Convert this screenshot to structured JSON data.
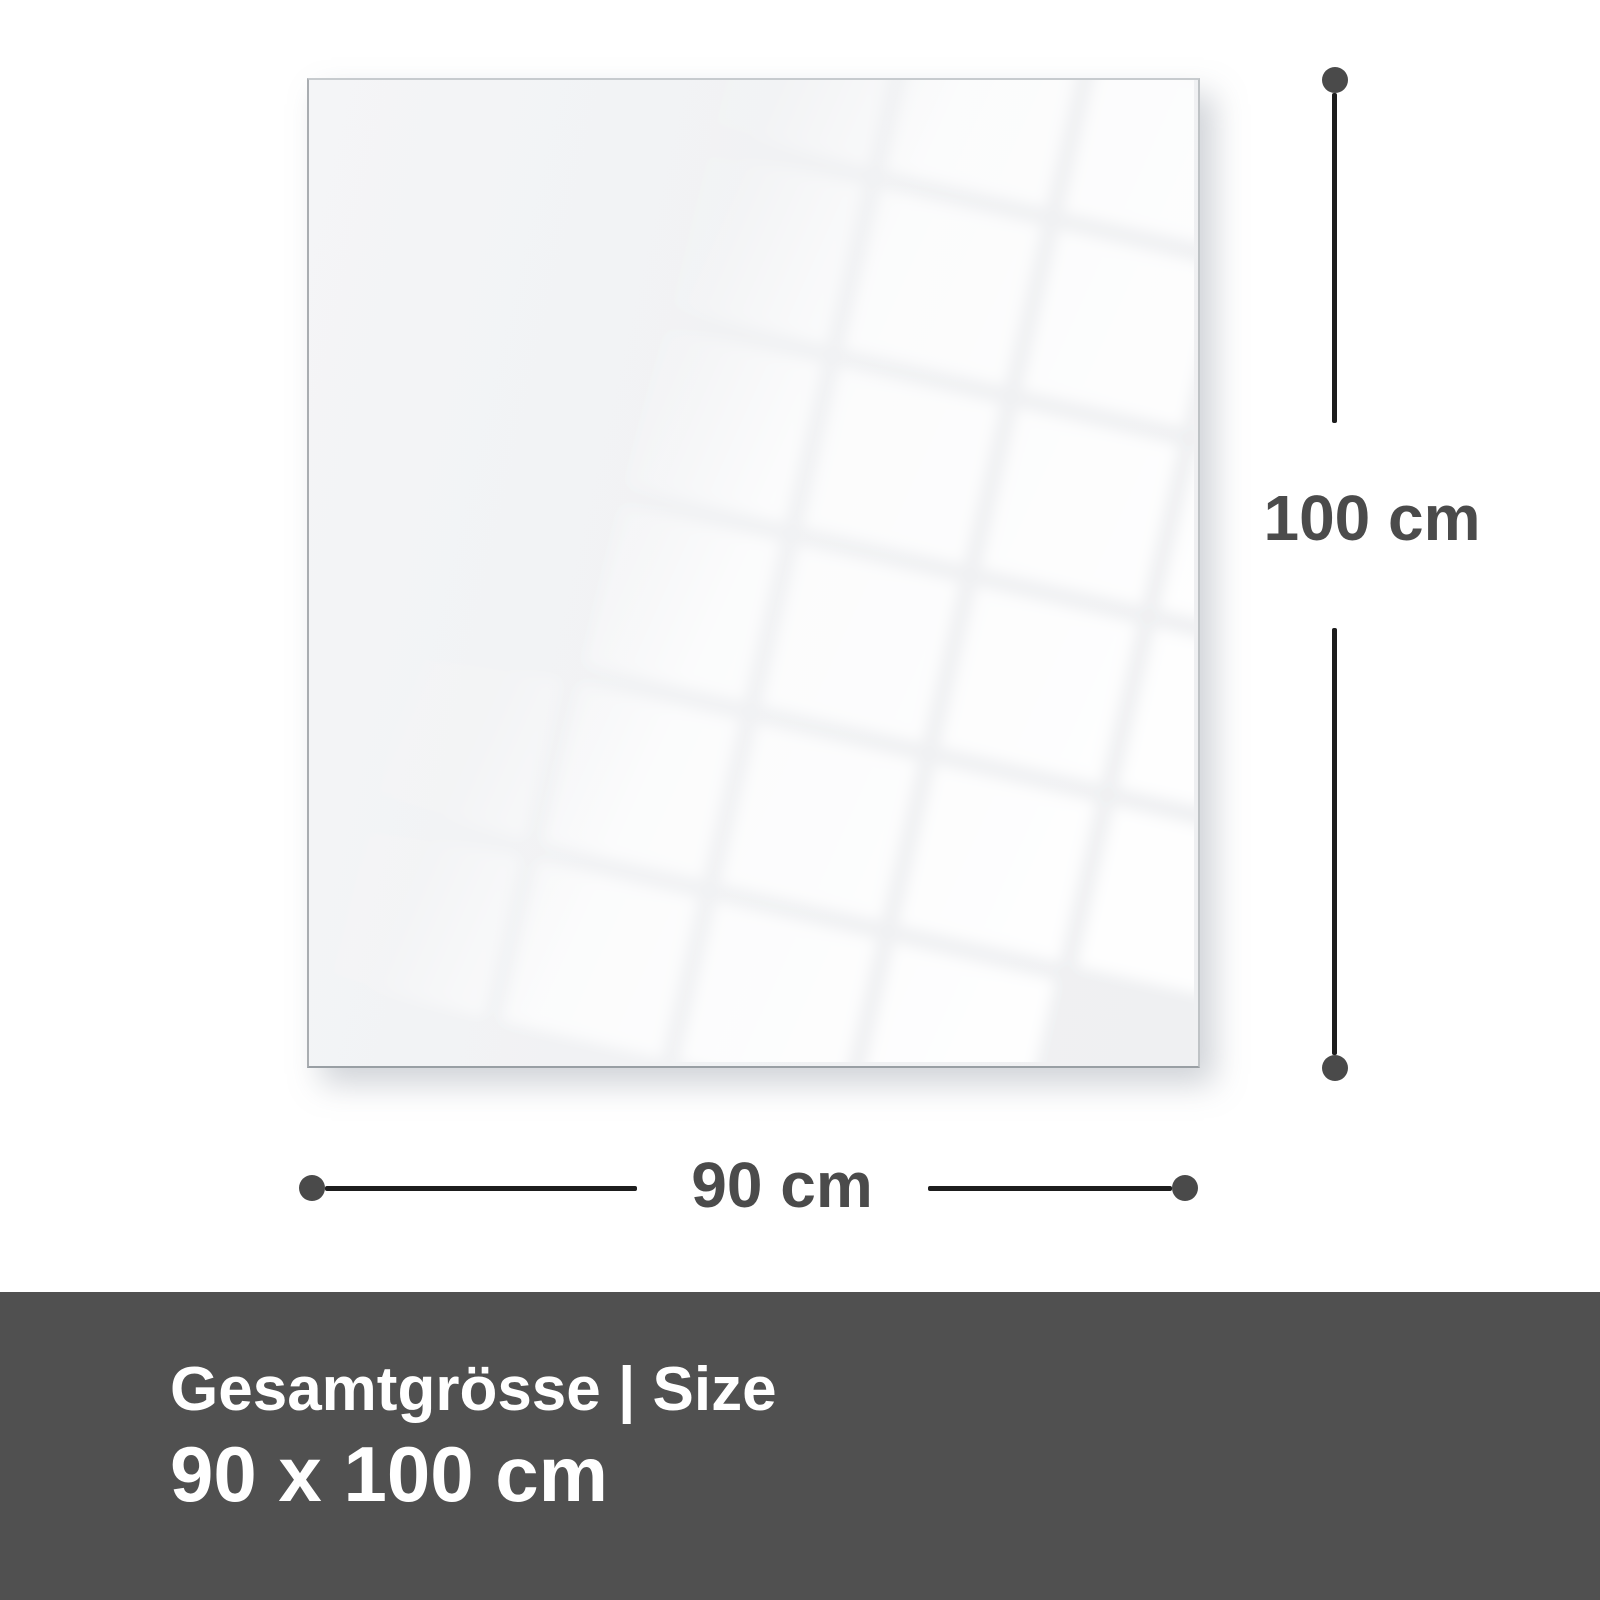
{
  "diagram": {
    "type": "product-size-diagram",
    "panel": {
      "name": "glass-panel",
      "fill": "#f1f2f4",
      "edge_color": "#a9adb1",
      "reflection": "tilted-window-grid"
    },
    "dimensions": {
      "height": {
        "value": 100,
        "unit": "cm",
        "label": "100 cm"
      },
      "width": {
        "value": 90,
        "unit": "cm",
        "label": "90 cm"
      }
    }
  },
  "footer": {
    "title": "Gesamtgrösse | Size",
    "size": "90 x 100 cm",
    "background": "#505050",
    "text_color": "#ffffff"
  },
  "colors": {
    "dimension_text": "#4b4b4b",
    "dimension_line": "#1d1d1d",
    "dimension_dot": "#4a4a4a",
    "page_background": "#ffffff"
  }
}
